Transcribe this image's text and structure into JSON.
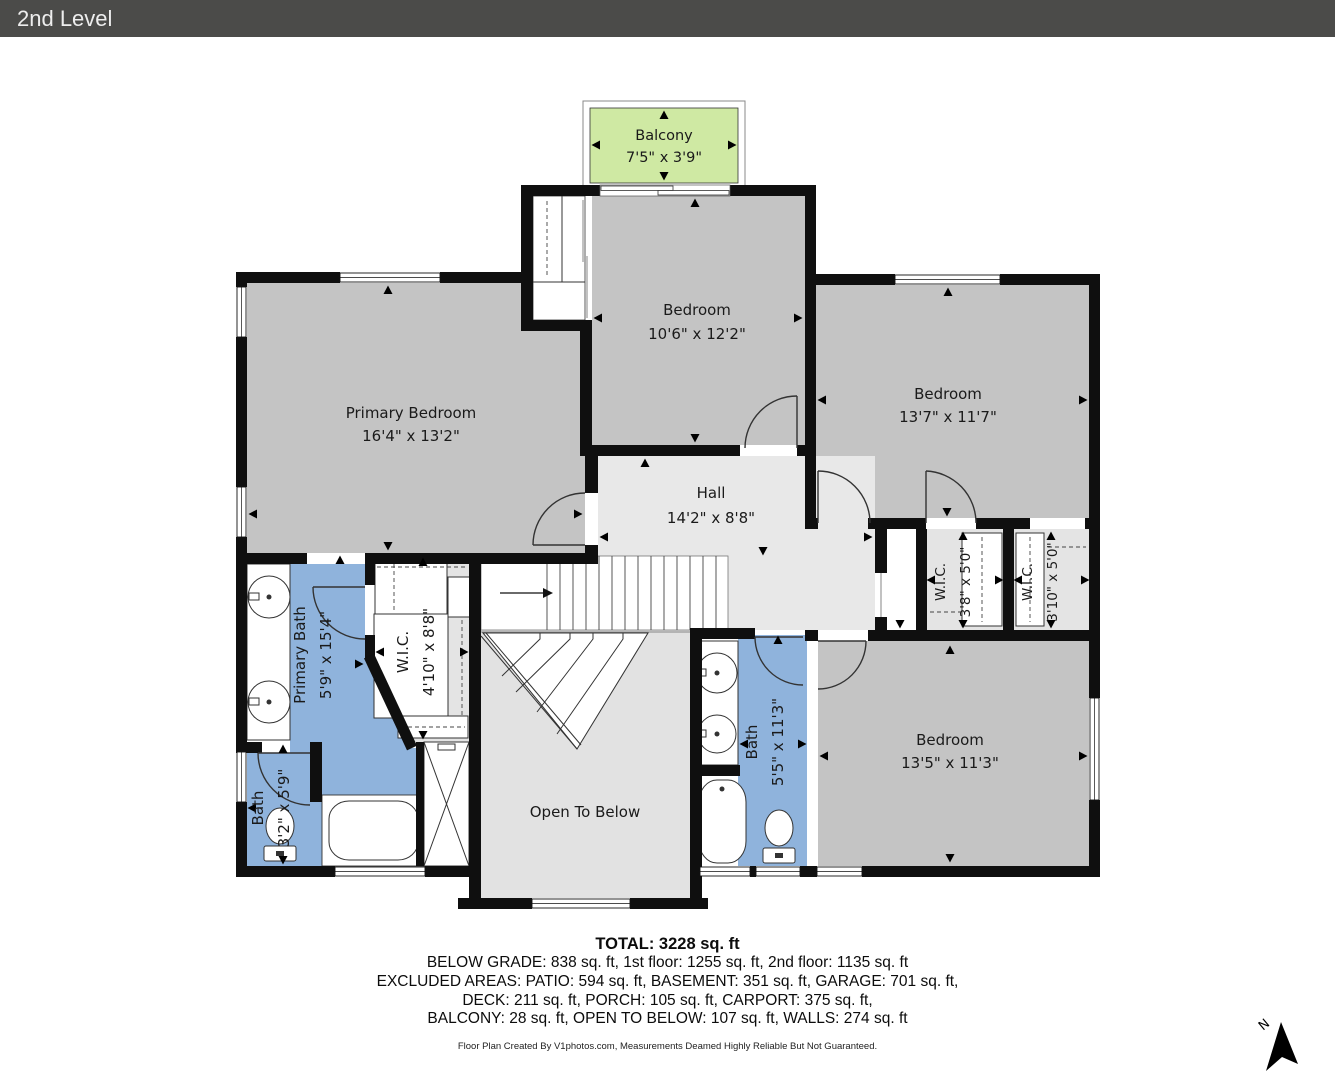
{
  "header": {
    "title": "2nd Level"
  },
  "colors": {
    "headerBg": "#4b4b49",
    "wall": "#0f0f0f",
    "bedroom": "#c4c4c4",
    "hall": "#e8e8e8",
    "otb": "#e2e2e2",
    "wic": "#e4e4e4",
    "bath": "#8fb3dc",
    "balcony": "#cfe9a3"
  },
  "rooms": {
    "balcony": {
      "name": "Balcony",
      "dims": "7'5\" x 3'9\""
    },
    "primary_bedroom": {
      "name": "Primary Bedroom",
      "dims": "16'4\" x 13'2\""
    },
    "bedroom_top": {
      "name": "Bedroom",
      "dims": "10'6\" x 12'2\""
    },
    "bedroom_right": {
      "name": "Bedroom",
      "dims": "13'7\" x 11'7\""
    },
    "hall": {
      "name": "Hall",
      "dims": "14'2\" x 8'8\""
    },
    "primary_bath": {
      "name": "Primary Bath",
      "dims": "5'9\" x 15'4\""
    },
    "wic_main": {
      "name": "W.I.C.",
      "dims": "4'10\" x 8'8\""
    },
    "bath_small": {
      "name": "Bath",
      "dims": "3'2\" x 5'9\""
    },
    "bath_hall": {
      "name": "Bath",
      "dims": "5'5\" x 11'3\""
    },
    "wic_left": {
      "name": "W.I.C.",
      "dims": "3'8\" x 5'0\""
    },
    "wic_right": {
      "name": "W.I.C.",
      "dims": "3'10\" x 5'0\""
    },
    "bedroom_bottom": {
      "name": "Bedroom",
      "dims": "13'5\" x 11'3\""
    },
    "open_to_below": {
      "name": "Open To Below"
    }
  },
  "summary": {
    "total": "TOTAL: 3228 sq. ft",
    "line1": "BELOW GRADE: 838 sq. ft, 1st floor: 1255 sq. ft, 2nd floor: 1135 sq. ft",
    "line2": "EXCLUDED AREAS: PATIO: 594 sq. ft, BASEMENT: 351 sq. ft, GARAGE: 701 sq. ft,",
    "line3": "DECK: 211 sq. ft, PORCH: 105 sq. ft, CARPORT: 375 sq. ft,",
    "line4": "BALCONY: 28 sq. ft, OPEN TO BELOW: 107 sq. ft, WALLS: 274 sq. ft"
  },
  "disclaimer": "Floor Plan Created By V1photos.com, Measurements Deamed Highly Reliable But Not Guaranteed.",
  "compass": {
    "label": "N"
  }
}
